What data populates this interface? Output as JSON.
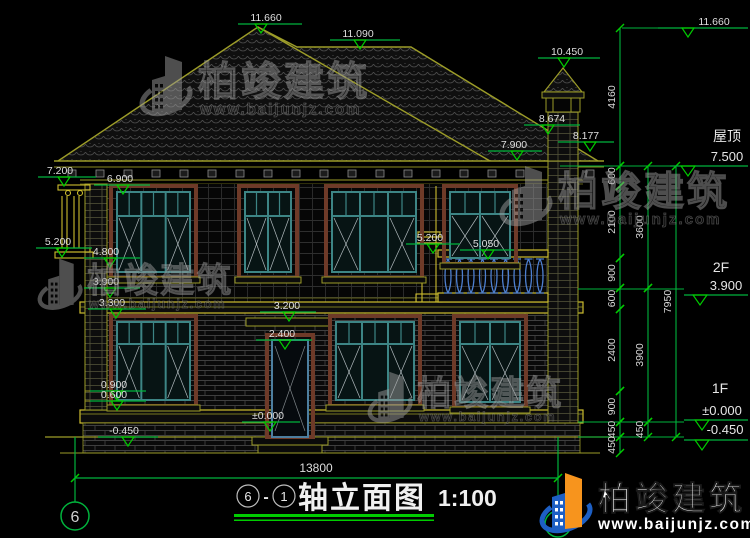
{
  "colors": {
    "dim_green": "#00b33c",
    "bright_green": "#00cc00",
    "olive": "#9c9c28",
    "bright_yellow": "#cdbd2e",
    "white_text": "#dfdfdf",
    "teal_frame": "#3d8585",
    "maroon_trim": "#6e3a28",
    "baluster_blue": "#4d7fd0",
    "watermark_gray": "#9b9b9b",
    "logo_blue": "#1d5fc4",
    "logo_orange": "#f7941d"
  },
  "watermark": {
    "brand": "柏竣建筑",
    "url": "www.baijunjz.com"
  },
  "logo": {
    "brand": "柏竣建筑",
    "url": "www.baijunjz.com"
  },
  "title_bar": {
    "axis_from": "6",
    "separator": "-",
    "axis_to": "1",
    "name": "轴立面图",
    "scale": "1:100"
  },
  "bottom_dimension": "13800",
  "axis_bubble_left": "6",
  "right_labels": [
    {
      "text": "屋顶",
      "x": 727,
      "y": 141,
      "size": 14
    },
    {
      "text": "7.500",
      "x": 727,
      "y": 161,
      "size": 13,
      "line": [
        670,
        748,
        166
      ],
      "tri": 688
    },
    {
      "text": "2F",
      "x": 721,
      "y": 272,
      "size": 14
    },
    {
      "text": "3.900",
      "x": 726,
      "y": 290,
      "size": 13,
      "line": [
        684,
        748,
        295
      ],
      "tri": 700
    },
    {
      "text": "1F",
      "x": 720,
      "y": 393,
      "size": 14
    },
    {
      "text": "±0.000",
      "x": 722,
      "y": 415,
      "size": 13,
      "line": [
        684,
        748,
        420
      ],
      "tri": 702
    },
    {
      "text": "-0.450",
      "x": 725,
      "y": 434,
      "size": 13,
      "line": [
        684,
        748,
        440
      ],
      "tri": 702
    }
  ],
  "elevation_markers": [
    {
      "t": "11.660",
      "tx": 266,
      "ly": 24,
      "lx1": 238,
      "lx2": 302,
      "ax": 261
    },
    {
      "t": "11.660",
      "tx": 714,
      "ly": 28,
      "lx1": 658,
      "lx2": 748,
      "ax": 688
    },
    {
      "t": "11.090",
      "tx": 358,
      "ly": 40,
      "lx1": 330,
      "lx2": 400,
      "ax": 360
    },
    {
      "t": "10.450",
      "tx": 567,
      "ly": 58,
      "lx1": 538,
      "lx2": 600,
      "ax": 564
    },
    {
      "t": "8.674",
      "tx": 552,
      "ly": 125,
      "lx1": 524,
      "lx2": 580,
      "ax": 548
    },
    {
      "t": "8.177",
      "tx": 586,
      "ly": 142,
      "lx1": 558,
      "lx2": 614,
      "ax": 590
    },
    {
      "t": "7.900",
      "tx": 514,
      "ly": 151,
      "lx1": 488,
      "lx2": 542,
      "ax": 517
    },
    {
      "t": "7.200",
      "tx": 60,
      "ly": 177,
      "lx1": 38,
      "lx2": 96,
      "ax": 64
    },
    {
      "t": "6.900",
      "tx": 120,
      "ly": 185,
      "lx1": 94,
      "lx2": 150,
      "ax": 123
    },
    {
      "t": "5.200",
      "tx": 58,
      "ly": 248,
      "lx1": 36,
      "lx2": 92,
      "ax": 62
    },
    {
      "t": "4.800",
      "tx": 106,
      "ly": 258,
      "lx1": 84,
      "lx2": 140,
      "ax": 110
    },
    {
      "t": "5.200",
      "tx": 430,
      "ly": 244,
      "lx1": 406,
      "lx2": 460,
      "ax": 433
    },
    {
      "t": "5.050",
      "tx": 486,
      "ly": 250,
      "lx1": 460,
      "lx2": 514,
      "ax": 488
    },
    {
      "t": "3.900",
      "tx": 106,
      "ly": 288,
      "lx1": 84,
      "lx2": 140,
      "ax": 110
    },
    {
      "t": "3.300",
      "tx": 112,
      "ly": 309,
      "lx1": 88,
      "lx2": 146,
      "ax": 116
    },
    {
      "t": "3.200",
      "tx": 287,
      "ly": 312,
      "lx1": 260,
      "lx2": 316,
      "ax": 289
    },
    {
      "t": "2.400",
      "tx": 282,
      "ly": 340,
      "lx1": 256,
      "lx2": 312,
      "ax": 285
    },
    {
      "t": "0.900",
      "tx": 114,
      "ly": 391,
      "lx1": 90,
      "lx2": 146,
      "ax": 117
    },
    {
      "t": "0.600",
      "tx": 114,
      "ly": 401,
      "lx1": 90,
      "lx2": 146,
      "ax": 117
    },
    {
      "t": "±0.000",
      "tx": 268,
      "ly": 422,
      "lx1": 242,
      "lx2": 300,
      "ax": 270
    },
    {
      "t": "-0.450",
      "tx": 124,
      "ly": 437,
      "lx1": 98,
      "lx2": 158,
      "ax": 128
    }
  ],
  "dim_chains": [
    {
      "x": 620,
      "segments": [
        {
          "label": "4160",
          "y1": 28,
          "y2": 166
        },
        {
          "label": "600",
          "y1": 166,
          "y2": 186
        },
        {
          "label": "2100",
          "y1": 186,
          "y2": 258
        },
        {
          "label": "900",
          "y1": 258,
          "y2": 288
        },
        {
          "label": "600",
          "y1": 288,
          "y2": 309
        },
        {
          "label": "2400",
          "y1": 309,
          "y2": 391
        },
        {
          "label": "900",
          "y1": 391,
          "y2": 422
        },
        {
          "label": "450",
          "y1": 422,
          "y2": 437
        },
        {
          "label": "450",
          "y1": 437,
          "y2": 453
        }
      ]
    },
    {
      "x": 648,
      "segments": [
        {
          "label": "3600",
          "y1": 166,
          "y2": 288
        },
        {
          "label": "3900",
          "y1": 288,
          "y2": 422
        },
        {
          "label": "450",
          "y1": 422,
          "y2": 437
        }
      ]
    },
    {
      "x": 676,
      "segments": [
        {
          "label": "7950",
          "y1": 166,
          "y2": 437
        }
      ]
    }
  ],
  "green_connectors": [
    [
      560,
      166,
      670,
      166
    ],
    [
      622,
      28,
      658,
      28
    ],
    [
      578,
      289,
      684,
      289
    ],
    [
      578,
      422,
      684,
      422
    ],
    [
      578,
      437,
      684,
      437
    ]
  ],
  "watermark_positions": [
    {
      "x": 140,
      "y": 48,
      "s": 1.0
    },
    {
      "x": 500,
      "y": 158,
      "s": 1.0
    },
    {
      "x": 38,
      "y": 252,
      "s": 0.85
    },
    {
      "x": 368,
      "y": 365,
      "s": 0.85
    }
  ],
  "facade": {
    "windows": [
      {
        "x": 117,
        "y": 192,
        "w": 73,
        "h": 80,
        "cols": 3,
        "t": 24
      },
      {
        "x": 245,
        "y": 192,
        "w": 46,
        "h": 80,
        "cols": 2,
        "t": 24
      },
      {
        "x": 332,
        "y": 192,
        "w": 84,
        "h": 80,
        "cols": 3,
        "t": 24
      },
      {
        "x": 450,
        "y": 192,
        "w": 60,
        "h": 66,
        "cols": 2,
        "t": 22
      },
      {
        "x": 117,
        "y": 322,
        "w": 73,
        "h": 78,
        "cols": 3,
        "t": 22
      },
      {
        "x": 336,
        "y": 322,
        "w": 78,
        "h": 78,
        "cols": 3,
        "t": 22
      },
      {
        "x": 460,
        "y": 322,
        "w": 60,
        "h": 80,
        "cols": 2,
        "t": 22
      }
    ],
    "door": {
      "x": 272,
      "y": 340,
      "w": 36,
      "h": 97
    }
  }
}
